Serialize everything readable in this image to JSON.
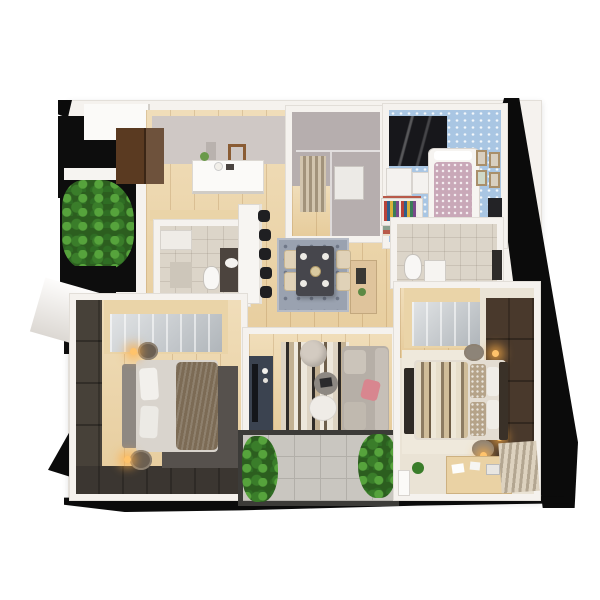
{
  "scene": {
    "type": "3d-floor-plan-render",
    "title": "Apartment 3D floor plan (top-down cutaway render, no visible text)",
    "view": "top-down isometric cutaway on white background with black cast shadows",
    "rooms": [
      {
        "name": "Entry Hall",
        "items": [
          "white console table",
          "decor vases and plant",
          "wall picture frame",
          "dark brown entrance door",
          "oak floor"
        ]
      },
      {
        "name": "Side Balcony",
        "items": [
          "green hedge planter",
          "white railing",
          "black backdrop panel",
          "white awning ledge"
        ]
      },
      {
        "name": "Laundry / Shower Room",
        "items": [
          "hanging beige towels",
          "white towel stack",
          "glass partition",
          "grey walls"
        ]
      },
      {
        "name": "Kids Bedroom",
        "items": [
          "blue patterned floor",
          "dark open wardrobe",
          "white dresser",
          "white cot bed with mauve duvet",
          "gallery picture frames",
          "striped rug",
          "leaning dark frame"
        ]
      },
      {
        "name": "Bathroom 1",
        "items": [
          "dark vanity with white basin",
          "toilet",
          "white shelf",
          "beige tile floor",
          "wood lintel"
        ]
      },
      {
        "name": "Kitchen Bar",
        "items": [
          "white counter",
          "five black bar stools"
        ]
      },
      {
        "name": "Dining Area",
        "items": [
          "grey diamond-pattern rug",
          "dark dining table with place settings",
          "four beige chairs",
          "wood side console"
        ]
      },
      {
        "name": "Hallway Shelf",
        "items": [
          "bookshelf with colorful book spines"
        ]
      },
      {
        "name": "Bathroom 2",
        "items": [
          "toilet",
          "white vanity",
          "dark window strip",
          "beige tile floor"
        ]
      },
      {
        "name": "Bedroom 2",
        "items": [
          "dark grey-brown walls",
          "sliding glass wardrobe with wood frame",
          "bed with grey headboard and white pillows",
          "brown fur throw",
          "dark grey rug",
          "two round nightstands with lit lamps"
        ]
      },
      {
        "name": "Living Room",
        "items": [
          "striped rug",
          "grey sofa with pink pillow",
          "round pouf",
          "two round coffee tables",
          "dark TV cabinet"
        ]
      },
      {
        "name": "Bottom Balcony",
        "items": [
          "stone tile floor",
          "climbing green plants both sides",
          "dark frame"
        ]
      },
      {
        "name": "Master Bedroom",
        "items": [
          "dark brown paneled accent wall with lit wall lamps",
          "sliding glass wardrobe",
          "bed with banded duvet and patterned pillows",
          "dark foot bench",
          "cream rug",
          "round nightstands",
          "wood desk with papers",
          "pleated curtain",
          "small plant"
        ]
      }
    ],
    "palette": {
      "background": "#ffffff",
      "wall": "#f5f2ee",
      "wall_edge": "#e2ded8",
      "wood_floor": "#ecd4a6",
      "kids_floor_blue": "#a9c6e3",
      "laundry_wall": "#b6aeae",
      "bath_tile": "#dcd5c9",
      "balcony_tile": "#c9c6c0",
      "dining_rug": "#9aa2b0",
      "dark_rug": "#56514d",
      "cream_carpet": "#eae3d5",
      "bedroom_dark_wall": "#474139",
      "bedroom_dark_wall_bottom": "#3b3631",
      "master_accent_wall": "#49392c",
      "door_brown": "#5a3a21",
      "sofa_grey": "#b6afa7",
      "dining_table": "#46464c",
      "tv_cabinet": "#3b4350",
      "wardrobe_wood": "#ead4a8",
      "foliage_green": "#2c5e1f",
      "lamp_glow": "#ffb347",
      "shadow_black": "#0b0b0b",
      "pink_pillow": "#d8868f",
      "mauve_duvet": "#c9a8b8"
    }
  }
}
